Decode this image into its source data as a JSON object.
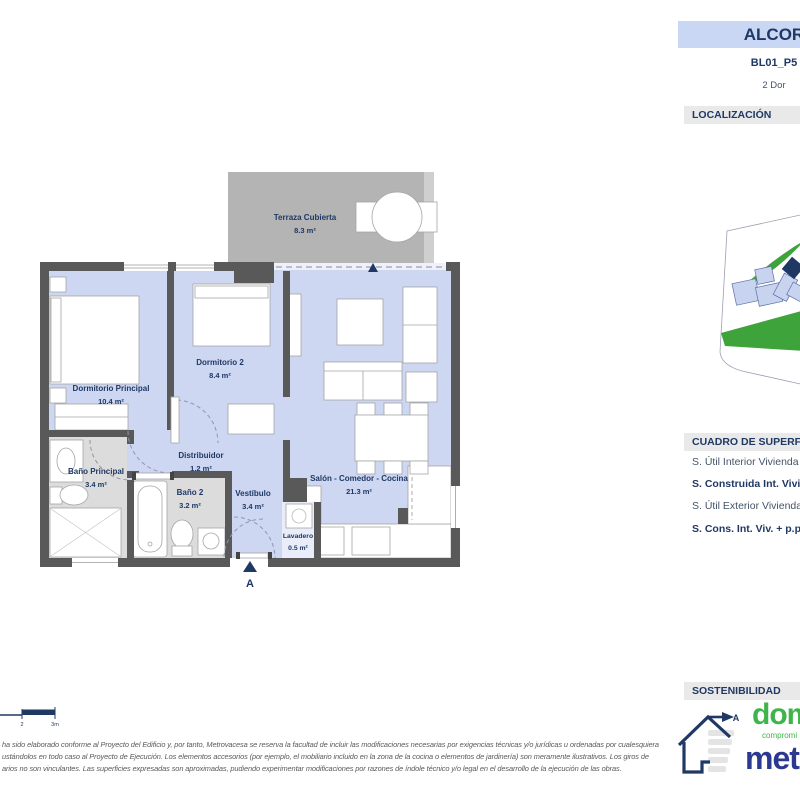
{
  "header": {
    "title": "ALCOR",
    "code": "BL01_P5",
    "type": "2 Dor"
  },
  "section_headers": {
    "localizacion": "LOCALIZACIÓN",
    "superficies": "CUADRO DE SUPERFICIES",
    "sostenibilidad": "SOSTENIBILIDAD"
  },
  "superficies": {
    "rows": [
      {
        "label": "S. Útil Interior Vivienda"
      },
      {
        "label": "S. Construida Int. Vivienda"
      },
      {
        "label": "S. Útil Exterior Vivienda"
      },
      {
        "label": "S. Cons. Int. Viv. + p.p. ZZCC"
      }
    ]
  },
  "plan": {
    "rooms": [
      {
        "name": "Terraza Cubierta",
        "area": "8.3 m²"
      },
      {
        "name": "Dormitorio Principal",
        "area": "10.4 m²"
      },
      {
        "name": "Dormitorio 2",
        "area": "8.4 m²"
      },
      {
        "name": "Salón - Comedor - Cocina",
        "area": "21.3 m²"
      },
      {
        "name": "Distribuidor",
        "area": "1.2 m²"
      },
      {
        "name": "Baño Principal",
        "area": "3.4 m²"
      },
      {
        "name": "Baño 2",
        "area": "3.2 m²"
      },
      {
        "name": "Vestíbulo",
        "area": "3.4 m²"
      },
      {
        "name": "Lavadero",
        "area": "0.5 m²"
      }
    ],
    "entrance_label": "A"
  },
  "scale_bar": {
    "tick_2": "2",
    "tick_3": "3m"
  },
  "energy": {
    "rating_label": "A"
  },
  "branding": {
    "domum": "domu",
    "domum_sub": "compromi",
    "metrovacesa": "metr"
  },
  "disclaimer": {
    "line1": "ha sido elaborado conforme al Proyecto del Edificio y, por tanto, Metrovacesa se reserva la facultad de incluir las modificaciones necesarias por exigencias técnicas y/o jurídicas u ordenadas por cualesquiera",
    "line2": "ustándolos en todo caso al Proyecto de Ejecución. Los elementos accesorios (por ejemplo, el mobiliario incluido en la zona de la cocina o elementos de jardinería) son meramente ilustrativos. Los giros de",
    "line3": "arios no son vinculantes. Las superficies expresadas son aproximadas, pudiendo experimentar modificaciones por razones de índole técnico y/o legal en el desarrollo de la ejecución de las obras."
  },
  "colors": {
    "accent_navy": "#1F3864",
    "room_fill": "#CDD7F2",
    "wall_gray": "#595959",
    "bath_floor": "#DCDCDC",
    "terrace_gray": "#B4B4B4",
    "header_bar_bg": "#E9E9E9",
    "title_box_bg": "#C9D6F4",
    "map_green": "#3FA33C",
    "logo_green": "#3DB54A",
    "logo_blue": "#2B3990"
  }
}
